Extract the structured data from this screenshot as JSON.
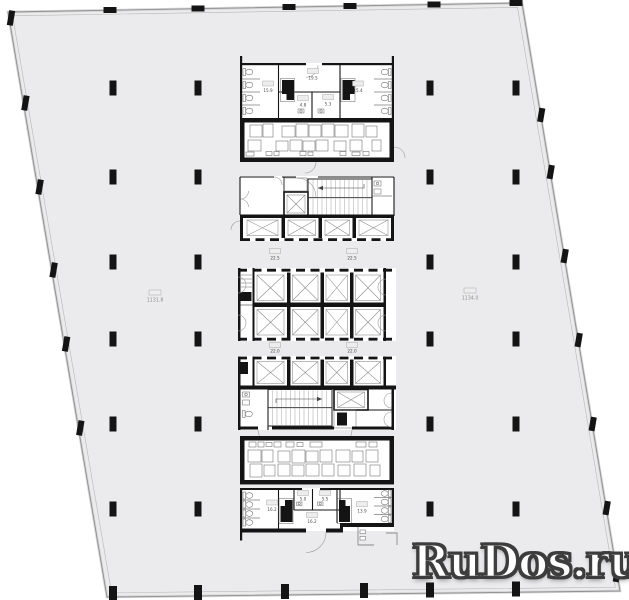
{
  "watermark": {
    "text": "RuDos.ru"
  },
  "areas": {
    "left": {
      "value": "1131.8"
    },
    "right": {
      "value": "1134.0"
    }
  },
  "core": {
    "top": {
      "wc_left": "15.9",
      "lobby": "19.5",
      "room_left": "4.8",
      "room_right": "5.3",
      "wc_right": "15.4"
    },
    "landing_upper": {
      "left": "22.5",
      "right": "22.5"
    },
    "landing_lower": {
      "left": "22.0",
      "right": "22.0"
    },
    "bottom": {
      "wc_left": "16.2",
      "room_left": "5.0",
      "room_right": "5.5",
      "wc_right": "13.9",
      "corridor": "16.2"
    }
  },
  "colors": {
    "page_bg": "#ffffff",
    "field": "#ebebed",
    "wall": "#141414",
    "line_gray": "#8f8f8f",
    "label": "#4a4a4a",
    "area_label": "#8f8f8f",
    "watermark_fill": "#ffffff",
    "watermark_outline": "#3d3d3d"
  }
}
